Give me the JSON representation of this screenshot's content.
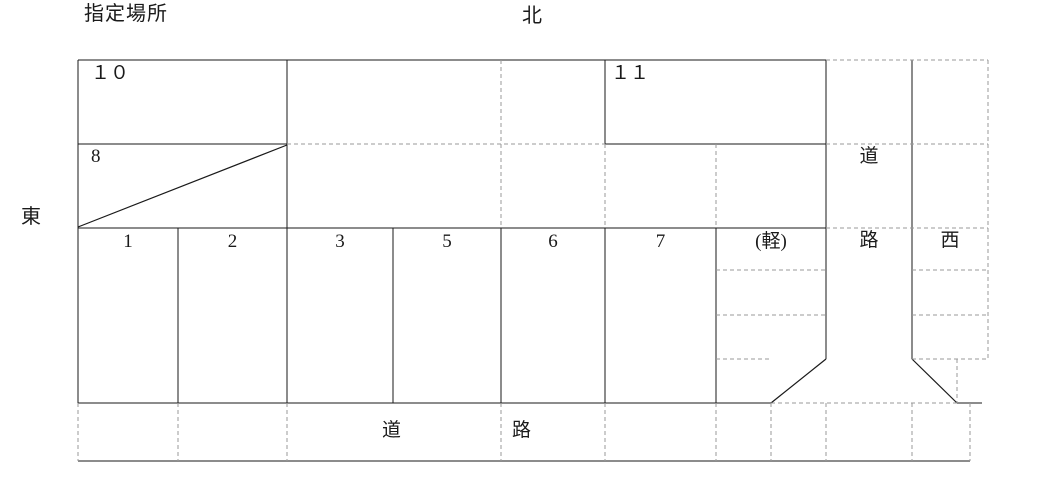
{
  "page": {
    "title_label": "指定場所"
  },
  "compass": {
    "north": "北",
    "east": "東",
    "west": "西"
  },
  "stalls": {
    "upper": {
      "spot10": "１０",
      "spot8": "8",
      "spot11": "１１"
    },
    "row": [
      "1",
      "2",
      "3",
      "5",
      "6",
      "7",
      "(軽)"
    ]
  },
  "roads": {
    "right_column": {
      "char1": "道",
      "char2": "路"
    },
    "bottom_strip": {
      "char1": "道",
      "char2": "路"
    }
  },
  "colors": {
    "solid_line": "#1a1a1a",
    "dashed_line": "#999999",
    "background": "#ffffff",
    "text": "#1a1a1a"
  }
}
